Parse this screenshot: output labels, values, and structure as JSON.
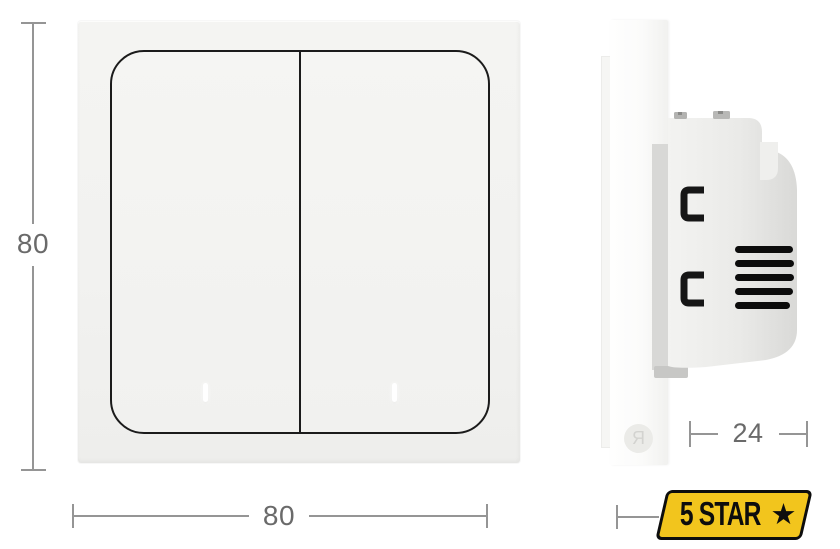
{
  "dimensions": {
    "height": "80",
    "width": "80",
    "depth": "24"
  },
  "side": {
    "logo_letter": "Я"
  },
  "badge": {
    "text": "5 STAR",
    "star": "★",
    "background": "#F2C51D",
    "border_color": "#0D0D0D",
    "text_color": "#0D0D0D"
  },
  "colors": {
    "page_background": "#FFFFFF",
    "plate": "#F2F2F0",
    "button_outline": "#1B1B1B",
    "switch_body": "#E8E8E6",
    "vent_slot": "#0C0C0C",
    "clip": "#161616",
    "indicator": "#FFFFFF",
    "dimension_line": "#959595",
    "dimension_text": "#6A6A6A"
  }
}
